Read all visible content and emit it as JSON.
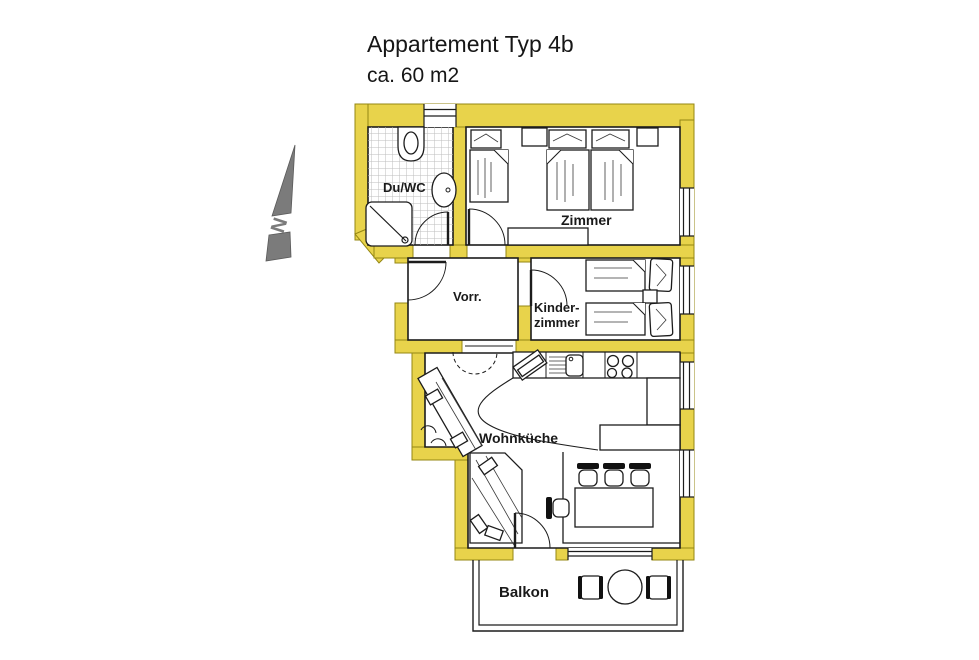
{
  "title": {
    "line1": "Appartement Typ 4b",
    "line2": "ca. 60 m2"
  },
  "compass": {
    "label": "N"
  },
  "rooms": {
    "shower_wc": {
      "label": "Du/WC"
    },
    "bedroom": {
      "label": "Zimmer"
    },
    "hallway": {
      "label": "Vorr."
    },
    "kids_room": {
      "line1": "Kinder-",
      "line2": "zimmer"
    },
    "living_kitchen": {
      "label": "Wohnküche"
    },
    "balcony": {
      "label": "Balkon"
    }
  },
  "colors": {
    "wall": "#e8d34b",
    "wall_edge": "#958713",
    "outline": "#1c1c1c",
    "compass_gray": "#7b7b7b",
    "background": "#ffffff"
  }
}
